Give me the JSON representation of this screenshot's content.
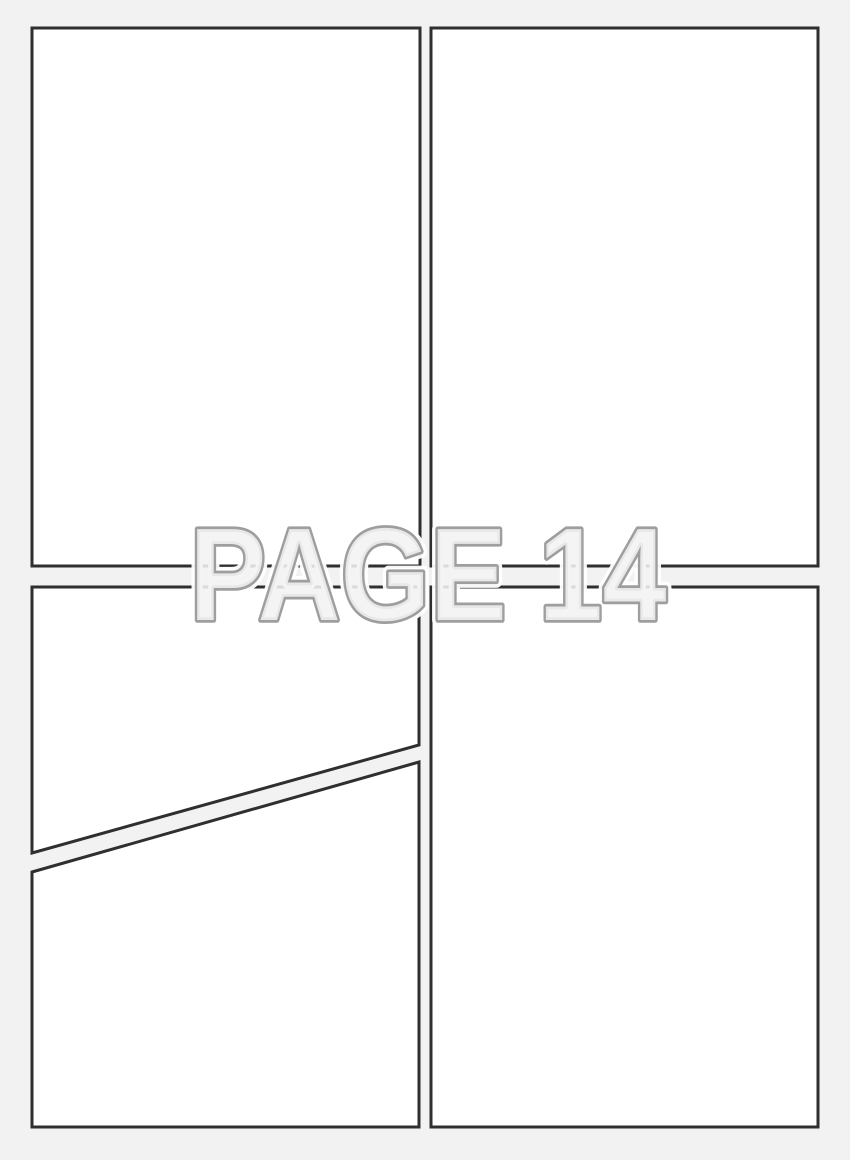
{
  "page": {
    "label": "PAGE 14",
    "width": 850,
    "height": 1160
  },
  "panels": [
    {
      "id": "panel-top-left",
      "shape": "rectangle",
      "content": ""
    },
    {
      "id": "panel-top-right",
      "shape": "rectangle",
      "content": ""
    },
    {
      "id": "panel-bottom-left-upper",
      "shape": "diagonal-quad",
      "content": ""
    },
    {
      "id": "panel-bottom-left-lower",
      "shape": "diagonal-quad",
      "content": ""
    },
    {
      "id": "panel-bottom-right",
      "shape": "rectangle",
      "content": ""
    }
  ],
  "colors": {
    "background": "#f2f2f2",
    "panel_fill": "#ffffff",
    "panel_border": "#2f2f2f",
    "label_fill": "#f2f2f2",
    "label_stroke": "#9e9e9e",
    "label_halo": "#ffffff"
  }
}
